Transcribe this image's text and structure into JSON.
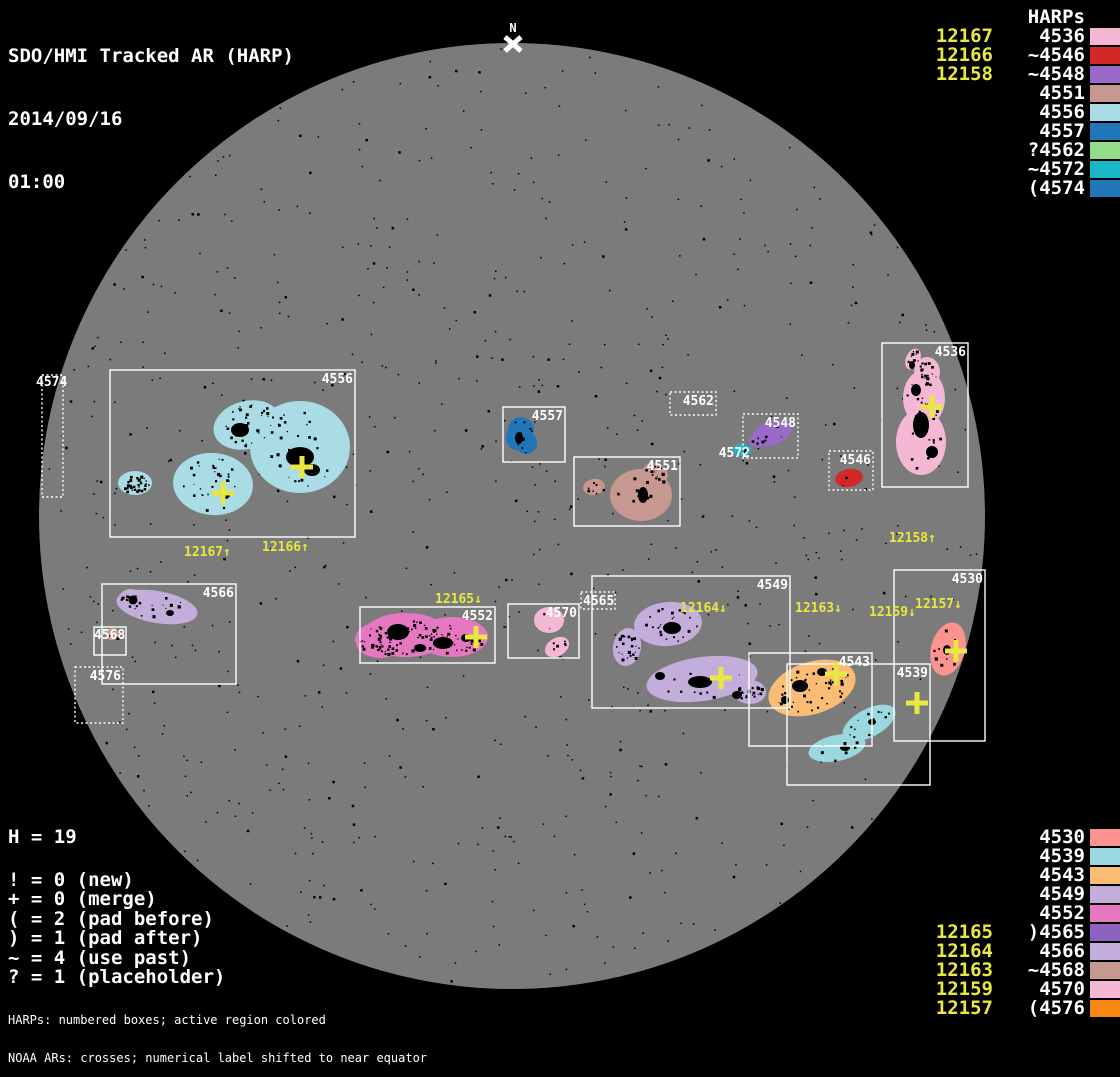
{
  "title": {
    "line1": "SDO/HMI Tracked AR (HARP)",
    "line2": "2014/09/16",
    "line3": "01:00"
  },
  "colors": {
    "background": "#000000",
    "disk": "#7b7b7b",
    "box_stroke": "#ffffff",
    "label_white": "#ffffff",
    "noaa_yellow": "#e8e840",
    "speckle": "#000000"
  },
  "north_marker": {
    "label": "N",
    "x": 513,
    "y": 44
  },
  "disk": {
    "cx": 512,
    "cy": 516,
    "r": 473
  },
  "legend_top": {
    "noaa_header": "NOAA ARs",
    "harp_header": "HARPs",
    "noaa": [
      "12167",
      "12166",
      "12158"
    ],
    "harps": [
      {
        "label": "4536",
        "color": "#f4b8d4"
      },
      {
        "label": "~4546",
        "color": "#d22828"
      },
      {
        "label": "~4548",
        "color": "#9a6ac8"
      },
      {
        "label": "4551",
        "color": "#c79890"
      },
      {
        "label": "4556",
        "color": "#aadce6"
      },
      {
        "label": "4557",
        "color": "#2176b8"
      },
      {
        "label": "?4562",
        "color": "#94dc8c"
      },
      {
        "label": "~4572",
        "color": "#1ab6c8"
      },
      {
        "label": "(4574",
        "color": "#2176b8"
      }
    ]
  },
  "legend_bottom": {
    "noaa": [
      "12165",
      "12164",
      "12163",
      "12159",
      "12157"
    ],
    "harps": [
      {
        "label": "4530",
        "color": "#fc938e"
      },
      {
        "label": "4539",
        "color": "#9ad8e0"
      },
      {
        "label": "4543",
        "color": "#fbbc76"
      },
      {
        "label": "4549",
        "color": "#c3addb"
      },
      {
        "label": "4552",
        "color": "#e678c2"
      },
      {
        "label": ")4565",
        "color": "#8c64c0"
      },
      {
        "label": "4566",
        "color": "#c3addb"
      },
      {
        "label": "~4568",
        "color": "#c79890"
      },
      {
        "label": "4570",
        "color": "#f4b8d4"
      },
      {
        "label": "(4576",
        "color": "#fa8712"
      }
    ]
  },
  "stats": {
    "h_line": "H = 19",
    "lines": [
      "! = 0 (new)",
      "+ = 0 (merge)",
      "( = 2 (pad before)",
      ") = 1 (pad after)",
      "~ = 4 (use past)",
      "? = 1 (placeholder)"
    ]
  },
  "footer": {
    "line1": "HARPs: numbered boxes; active region colored",
    "line2": "NOAA ARs: crosses; numerical label shifted to near equator"
  },
  "chart_data": {
    "type": "table",
    "title": "SDO/HMI Tracked AR (HARP) 2014/09/16 01:00",
    "columns": [
      "HARP",
      "flag",
      "color",
      "NOAA ARs (cross labels)"
    ],
    "rows": [
      [
        "4536",
        "",
        "#f4b8d4",
        "12158"
      ],
      [
        "4546",
        "~",
        "#d22828",
        ""
      ],
      [
        "4548",
        "~",
        "#9a6ac8",
        ""
      ],
      [
        "4551",
        "",
        "#c79890",
        ""
      ],
      [
        "4556",
        "",
        "#aadce6",
        "12167, 12166"
      ],
      [
        "4557",
        "",
        "#2176b8",
        ""
      ],
      [
        "4562",
        "?",
        "#94dc8c",
        ""
      ],
      [
        "4572",
        "~",
        "#1ab6c8",
        ""
      ],
      [
        "4574",
        "(",
        "#2176b8",
        ""
      ],
      [
        "4530",
        "",
        "#fc938e",
        "12157"
      ],
      [
        "4539",
        "",
        "#9ad8e0",
        "12159"
      ],
      [
        "4543",
        "",
        "#fbbc76",
        "12163"
      ],
      [
        "4549",
        "",
        "#c3addb",
        "12164"
      ],
      [
        "4552",
        "",
        "#e678c2",
        "12165"
      ],
      [
        "4565",
        ")",
        "#8c64c0",
        ""
      ],
      [
        "4566",
        "",
        "#c3addb",
        ""
      ],
      [
        "4568",
        "~",
        "#c79890",
        ""
      ],
      [
        "4570",
        "",
        "#f4b8d4",
        ""
      ],
      [
        "4576",
        "(",
        "#fa8712",
        ""
      ]
    ],
    "totals": {
      "H": 19,
      "new": 0,
      "merge": 0,
      "pad_before": 2,
      "pad_after": 1,
      "use_past": 4,
      "placeholder": 1
    }
  },
  "scene": {
    "boxes": [
      {
        "id": "4574",
        "x": 42,
        "y": 375,
        "w": 21,
        "h": 122,
        "dotted": true,
        "lx": 36,
        "ly": 386,
        "anchor": "start"
      },
      {
        "id": "4556",
        "x": 110,
        "y": 370,
        "w": 245,
        "h": 167,
        "dotted": false
      },
      {
        "id": "4557",
        "x": 503,
        "y": 407,
        "w": 62,
        "h": 55,
        "dotted": false
      },
      {
        "id": "4551",
        "x": 574,
        "y": 457,
        "w": 106,
        "h": 69,
        "dotted": false
      },
      {
        "id": "4562",
        "x": 670,
        "y": 392,
        "w": 46,
        "h": 23,
        "dotted": true
      },
      {
        "id": "4548",
        "x": 743,
        "y": 414,
        "w": 55,
        "h": 44,
        "dotted": true
      },
      {
        "id": "4546",
        "x": 829,
        "y": 451,
        "w": 44,
        "h": 39,
        "dotted": true
      },
      {
        "id": "4536",
        "x": 882,
        "y": 343,
        "w": 86,
        "h": 144,
        "dotted": false
      },
      {
        "id": "4566",
        "x": 102,
        "y": 584,
        "w": 134,
        "h": 100,
        "dotted": false
      },
      {
        "id": "4568",
        "x": 94,
        "y": 627,
        "w": 32,
        "h": 28,
        "dotted": false,
        "lx": 94,
        "ly": 639,
        "anchor": "start"
      },
      {
        "id": "4576",
        "x": 75,
        "y": 667,
        "w": 48,
        "h": 56,
        "dotted": true
      },
      {
        "id": "4552",
        "x": 360,
        "y": 607,
        "w": 135,
        "h": 56,
        "dotted": false
      },
      {
        "id": "4570",
        "x": 508,
        "y": 604,
        "w": 71,
        "h": 54,
        "dotted": false
      },
      {
        "id": "4565",
        "x": 581,
        "y": 592,
        "w": 34,
        "h": 17,
        "dotted": true,
        "lx": 583,
        "ly": 605,
        "anchor": "start"
      },
      {
        "id": "4549",
        "x": 592,
        "y": 576,
        "w": 198,
        "h": 132,
        "dotted": false
      },
      {
        "id": "4543",
        "x": 749,
        "y": 653,
        "w": 123,
        "h": 93,
        "dotted": false
      },
      {
        "id": "4539",
        "x": 787,
        "y": 664,
        "w": 143,
        "h": 121,
        "dotted": false
      },
      {
        "id": "4530",
        "x": 894,
        "y": 570,
        "w": 91,
        "h": 171,
        "dotted": false
      }
    ],
    "free_labels": [
      {
        "text": "4572",
        "x": 750,
        "y": 457,
        "anchor": "end"
      }
    ],
    "blobs": [
      {
        "id": "4556",
        "color": "#aadce6",
        "speckles": 130,
        "ellipses": [
          [
            300,
            447,
            50,
            46,
            0
          ],
          [
            247,
            425,
            34,
            24,
            -15
          ],
          [
            213,
            484,
            40,
            31,
            5
          ],
          [
            135,
            483,
            17,
            12,
            0
          ]
        ],
        "spots": [
          [
            300,
            457,
            28,
            20
          ],
          [
            240,
            430,
            18,
            14
          ],
          [
            312,
            470,
            16,
            12
          ],
          [
            225,
            495,
            10,
            8
          ]
        ]
      },
      {
        "id": "4557",
        "color": "#2176b8",
        "speckles": 10,
        "ellipses": [
          [
            521,
            430,
            13,
            13,
            0
          ],
          [
            526,
            443,
            11,
            11,
            0
          ],
          [
            516,
            438,
            10,
            12,
            0
          ]
        ],
        "spots": [
          [
            519,
            438,
            8,
            12
          ]
        ]
      },
      {
        "id": "4551",
        "color": "#c79890",
        "speckles": 30,
        "ellipses": [
          [
            641,
            495,
            31,
            26,
            0
          ],
          [
            655,
            474,
            13,
            11,
            20
          ],
          [
            594,
            487,
            11,
            8,
            -10
          ]
        ],
        "spots": [
          [
            643,
            495,
            10,
            16
          ]
        ]
      },
      {
        "id": "4548",
        "color": "#9a6ac8",
        "speckles": 8,
        "ellipses": [
          [
            772,
            433,
            21,
            12,
            -20
          ],
          [
            757,
            441,
            8,
            6,
            0
          ]
        ],
        "spots": []
      },
      {
        "id": "4572",
        "color": "#1ab6c8",
        "speckles": 2,
        "ellipses": [
          [
            742,
            450,
            9,
            6,
            0
          ]
        ],
        "spots": []
      },
      {
        "id": "4546",
        "color": "#d22828",
        "speckles": 2,
        "ellipses": [
          [
            849,
            478,
            14,
            9,
            -10
          ]
        ],
        "spots": []
      },
      {
        "id": "4536",
        "color": "#f4b8d4",
        "speckles": 60,
        "ellipses": [
          [
            924,
            398,
            21,
            28,
            0
          ],
          [
            921,
            442,
            25,
            33,
            0
          ],
          [
            927,
            372,
            13,
            15,
            0
          ],
          [
            913,
            359,
            7,
            11,
            25
          ]
        ],
        "spots": [
          [
            921,
            425,
            16,
            26
          ],
          [
            916,
            390,
            10,
            12
          ],
          [
            932,
            452,
            12,
            12
          ],
          [
            912,
            365,
            6,
            8
          ]
        ]
      },
      {
        "id": "4566",
        "color": "#c3addb",
        "speckles": 25,
        "ellipses": [
          [
            157,
            607,
            41,
            16,
            10
          ],
          [
            131,
            600,
            13,
            11,
            0
          ]
        ],
        "spots": [
          [
            133,
            600,
            9,
            9
          ],
          [
            170,
            613,
            8,
            6
          ]
        ]
      },
      {
        "id": "4568",
        "color": "#c79890",
        "speckles": 2,
        "ellipses": [
          [
            112,
            634,
            7,
            6,
            0
          ]
        ],
        "spots": []
      },
      {
        "id": "4552",
        "color": "#e678c2",
        "speckles": 110,
        "ellipses": [
          [
            406,
            635,
            43,
            22,
            0
          ],
          [
            452,
            637,
            36,
            20,
            0
          ],
          [
            380,
            640,
            25,
            18,
            0
          ]
        ],
        "spots": [
          [
            398,
            632,
            22,
            16
          ],
          [
            443,
            643,
            20,
            12
          ],
          [
            420,
            648,
            12,
            8
          ],
          [
            466,
            638,
            10,
            8
          ]
        ]
      },
      {
        "id": "4570",
        "color": "#f4b8d4",
        "speckles": 8,
        "ellipses": [
          [
            549,
            620,
            15,
            13,
            0
          ],
          [
            557,
            647,
            13,
            9,
            -30
          ]
        ],
        "spots": []
      },
      {
        "id": "4549",
        "color": "#c3addb",
        "speckles": 80,
        "ellipses": [
          [
            668,
            624,
            34,
            22,
            -5
          ],
          [
            627,
            647,
            14,
            19,
            10
          ],
          [
            702,
            679,
            56,
            22,
            -8
          ],
          [
            750,
            692,
            16,
            12,
            0
          ]
        ],
        "spots": [
          [
            672,
            628,
            18,
            12
          ],
          [
            700,
            682,
            24,
            12
          ],
          [
            660,
            676,
            10,
            8
          ],
          [
            737,
            695,
            10,
            8
          ]
        ]
      },
      {
        "id": "4543",
        "color": "#fbbc76",
        "speckles": 45,
        "ellipses": [
          [
            812,
            688,
            45,
            26,
            -18
          ]
        ],
        "spots": [
          [
            800,
            686,
            16,
            12
          ],
          [
            822,
            672,
            10,
            8
          ],
          [
            785,
            700,
            8,
            8
          ]
        ]
      },
      {
        "id": "4539",
        "color": "#9ad8e0",
        "speckles": 25,
        "ellipses": [
          [
            869,
            723,
            29,
            14,
            -28
          ],
          [
            837,
            748,
            29,
            13,
            -12
          ]
        ],
        "spots": [
          [
            845,
            748,
            10,
            6
          ],
          [
            872,
            722,
            8,
            6
          ]
        ]
      },
      {
        "id": "4530",
        "color": "#fc938e",
        "speckles": 8,
        "ellipses": [
          [
            948,
            649,
            17,
            27,
            15
          ]
        ],
        "spots": [
          [
            947,
            650,
            8,
            10
          ]
        ]
      }
    ],
    "crosses": [
      [
        223,
        493
      ],
      [
        302,
        467
      ],
      [
        932,
        407
      ],
      [
        476,
        637
      ],
      [
        721,
        678
      ],
      [
        836,
        674
      ],
      [
        917,
        703
      ],
      [
        956,
        651
      ]
    ],
    "noaa_disk_labels": [
      {
        "text": "12167↑",
        "x": 184,
        "y": 556
      },
      {
        "text": "12166↑",
        "x": 262,
        "y": 551
      },
      {
        "text": "12158↑",
        "x": 889,
        "y": 542
      },
      {
        "text": "12165↓",
        "x": 435,
        "y": 603
      },
      {
        "text": "12164↓",
        "x": 680,
        "y": 612
      },
      {
        "text": "12163↓",
        "x": 795,
        "y": 612
      },
      {
        "text": "12159↓",
        "x": 869,
        "y": 616
      },
      {
        "text": "12157↓",
        "x": 915,
        "y": 608
      }
    ]
  }
}
